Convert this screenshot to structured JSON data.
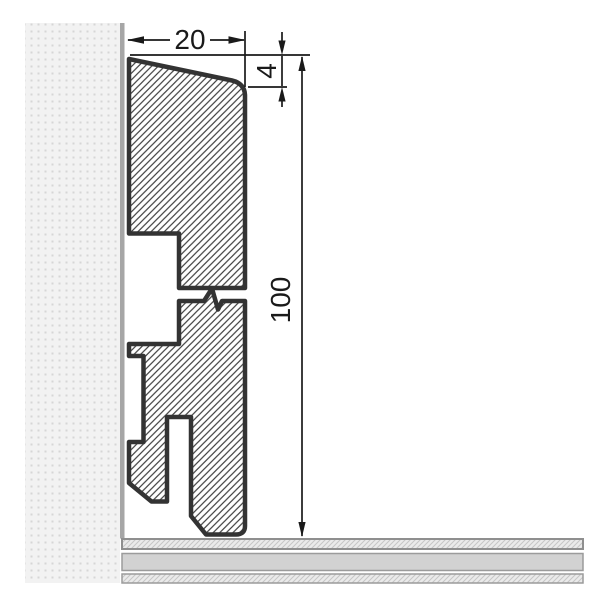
{
  "drawing": {
    "type": "technical-cross-section",
    "subject": "skirting-board-profile-on-wall-with-floor",
    "dimensions": {
      "width_mm": "20",
      "chamfer_mm": "4",
      "height_mm": "100"
    },
    "parts": [
      "wall",
      "skirting-profile",
      "floor"
    ],
    "features": [
      "top-chamfer",
      "back-recesses",
      "clip-slot",
      "break-line"
    ],
    "colors": {
      "background": "#ffffff",
      "outline": "#333333",
      "hatch_line": "#3f3f3f",
      "wall_fill": "#f2f2f2",
      "wall_dot": "#d6d6d6",
      "wall_edge": "#a6a6a6",
      "floor_solid": "#d2d2d2",
      "floor_hatch_bg": "#eaeaea",
      "floor_hatch_line": "#c6c6c6",
      "floor_edge": "#989898",
      "dimension_ink": "#1a1a1a"
    }
  }
}
